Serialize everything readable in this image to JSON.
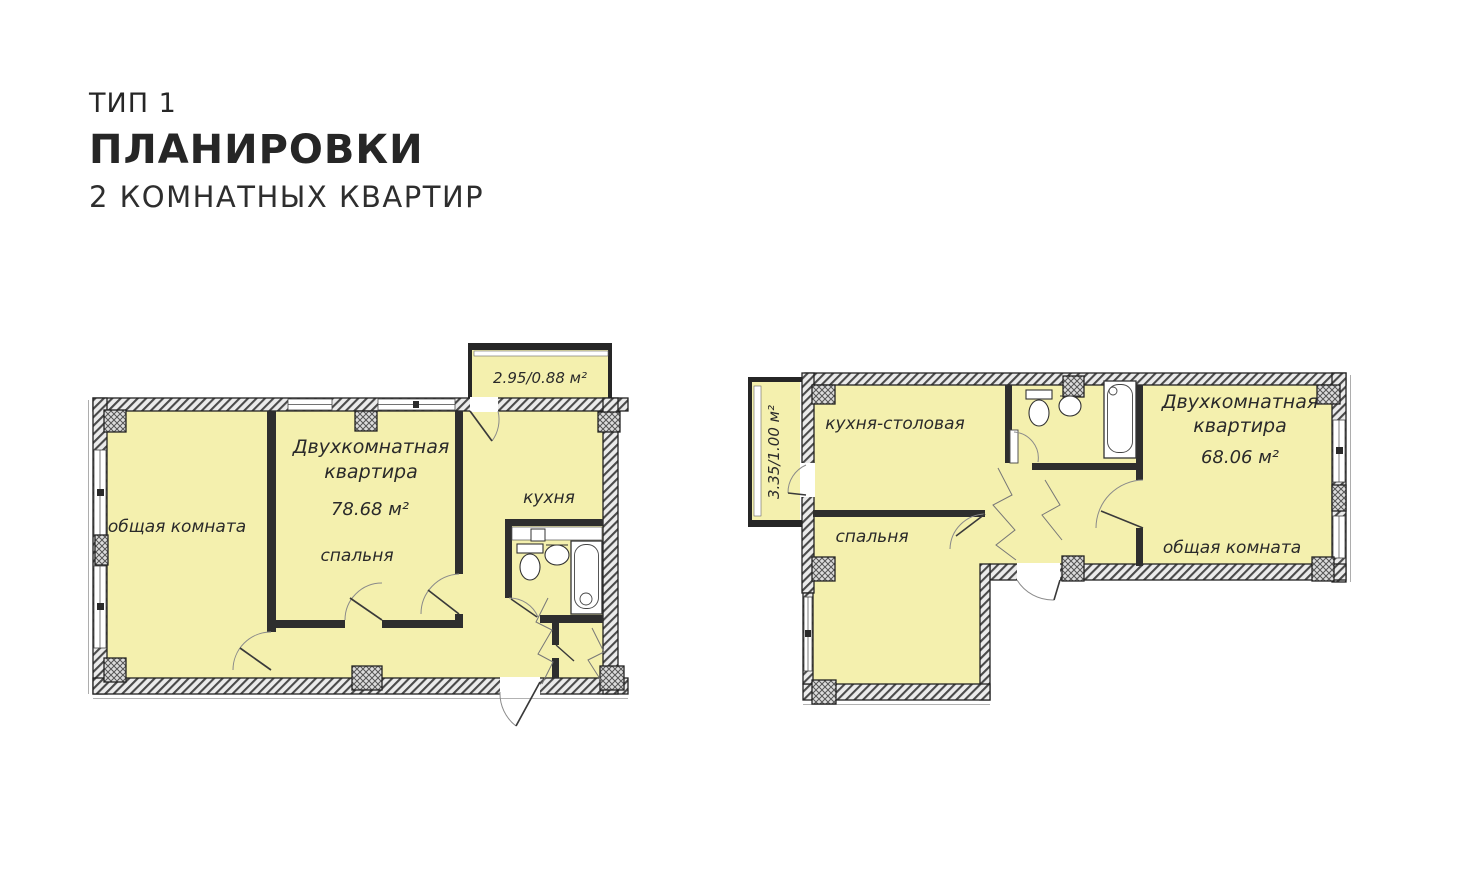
{
  "header": {
    "type_label": "ТИП 1",
    "title": "ПЛАНИРОВКИ",
    "subtitle": "2 КОМНАТНЫХ КВАРТИР"
  },
  "plan_left": {
    "balcony_area": "2.95/0.88 м²",
    "apartment_line1": "Двухкомнатная",
    "apartment_line2": "квартира",
    "area": "78.68 м²",
    "living_room": "общая комната",
    "bedroom": "спальня",
    "kitchen": "кухня"
  },
  "plan_right": {
    "balcony_area": "3.35/1.00 м²",
    "apartment_line1": "Двухкомнатная",
    "apartment_line2": "квартира",
    "area": "68.06 м²",
    "kitchen_dining": "кухня-столовая",
    "bedroom": "спальня",
    "living_room": "общая комната"
  },
  "colors": {
    "room_fill": "#f4f0ae",
    "wall_dark": "#262626",
    "hatch_background": "#ebebeb",
    "text": "#2a2a2a"
  }
}
